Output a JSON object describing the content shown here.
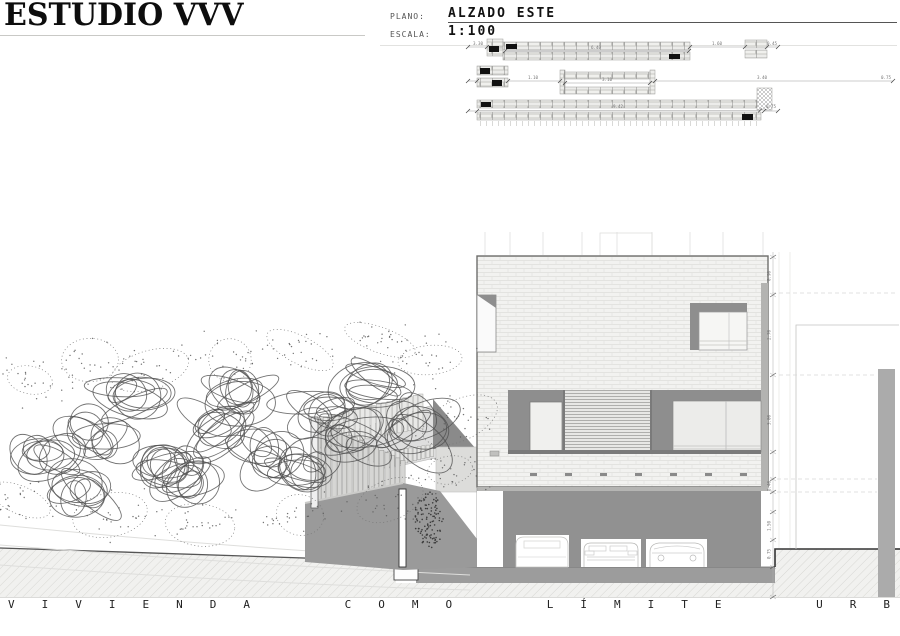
{
  "header": {
    "studio": "ESTUDIO VVV",
    "fields": [
      {
        "label": "PLANO:",
        "value": "ALZADO ESTE"
      },
      {
        "label": "ESCALA:",
        "value": "1:100"
      }
    ]
  },
  "key_plan": {
    "dims": [
      "3.30",
      "6.40",
      "1.60",
      "0.45",
      "1.10",
      "3.10",
      "3.40",
      "0.75",
      "9.42",
      "0.75"
    ]
  },
  "elevation": {
    "dims": [
      "0.90",
      "2.70",
      "3.00",
      "0.40",
      "1.50",
      "0.75"
    ]
  },
  "footer": {
    "motto": "VIVIENDA COMO LÍMITE URBANO"
  },
  "colors": {
    "facade_brick": "#f2f2f0",
    "panel_dark": "#8e8e8e",
    "wall_gray": "#9a9a9a",
    "ground_strip": "#9c9c9c",
    "line_dark": "#555555"
  }
}
